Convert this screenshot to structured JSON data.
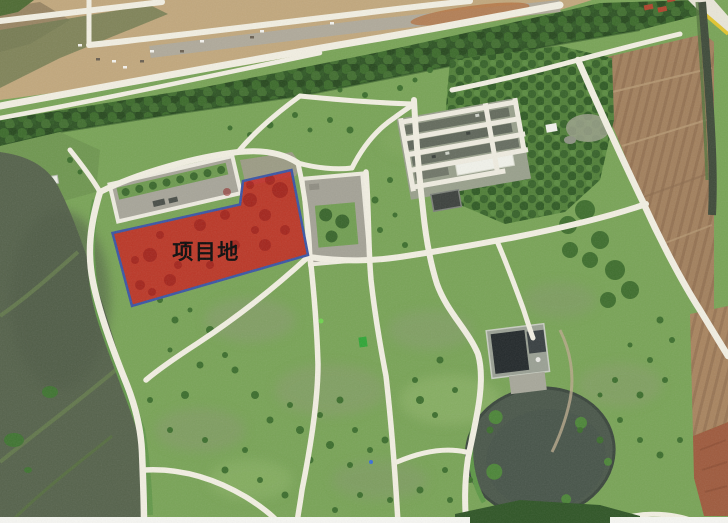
{
  "map": {
    "site": {
      "label": "项目地",
      "fill": "#c9201d",
      "stroke": "#3b55a5",
      "label_color": "#0b0b0b"
    }
  }
}
